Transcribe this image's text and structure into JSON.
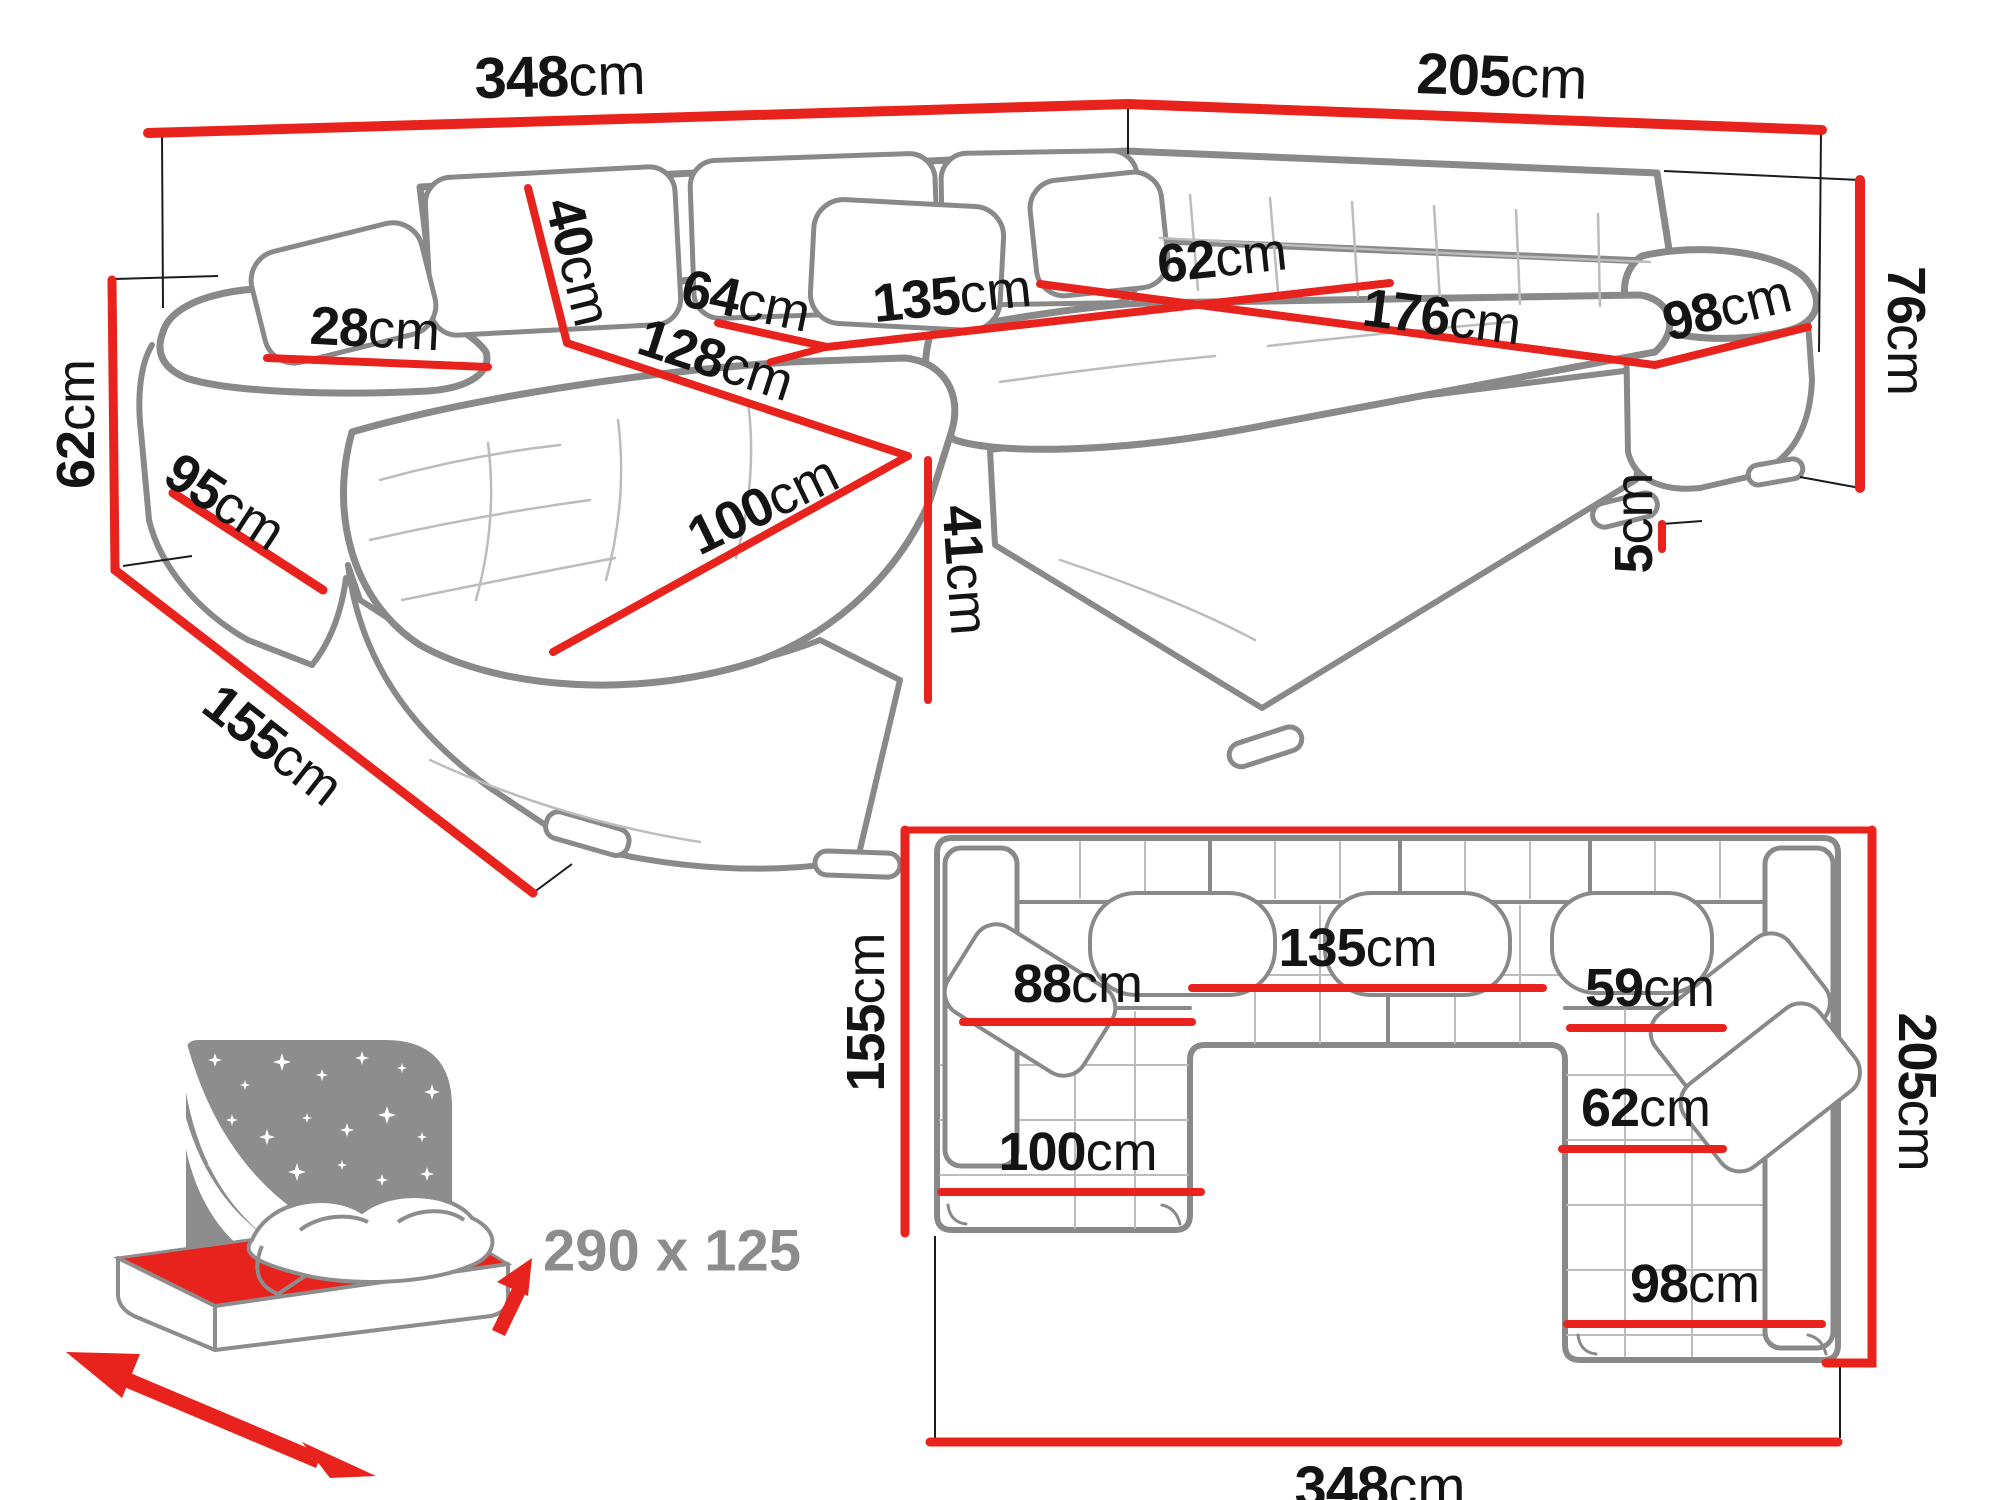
{
  "perspective": {
    "back_width": {
      "num": "348",
      "unit": "cm"
    },
    "right_back_width": {
      "num": "205",
      "unit": "cm"
    },
    "total_height": {
      "num": "76",
      "unit": "cm"
    },
    "armrest_height": {
      "num": "62",
      "unit": "cm"
    },
    "left_side_depth": {
      "num": "95",
      "unit": "cm"
    },
    "chaise_total_depth": {
      "num": "155",
      "unit": "cm"
    },
    "armrest_width": {
      "num": "28",
      "unit": "cm"
    },
    "back_cushion_height": {
      "num": "40",
      "unit": "cm"
    },
    "left_seat_depth": {
      "num": "64",
      "unit": "cm"
    },
    "middle_seat_width": {
      "num": "135",
      "unit": "cm"
    },
    "right_seat_depth": {
      "num": "62",
      "unit": "cm"
    },
    "right_seat_width": {
      "num": "176",
      "unit": "cm"
    },
    "right_end_width": {
      "num": "98",
      "unit": "cm"
    },
    "chaise_length": {
      "num": "128",
      "unit": "cm"
    },
    "chaise_width": {
      "num": "100",
      "unit": "cm"
    },
    "seat_height": {
      "num": "41",
      "unit": "cm"
    },
    "leg_height": {
      "num": "5",
      "unit": "cm"
    }
  },
  "plan": {
    "chaise_depth": {
      "num": "155",
      "unit": "cm"
    },
    "chaise_seat_width": {
      "num": "88",
      "unit": "cm"
    },
    "middle_seat_width": {
      "num": "135",
      "unit": "cm"
    },
    "right_seat_inner": {
      "num": "59",
      "unit": "cm"
    },
    "right_seat_depth": {
      "num": "62",
      "unit": "cm"
    },
    "chaise_width": {
      "num": "100",
      "unit": "cm"
    },
    "right_end_width": {
      "num": "98",
      "unit": "cm"
    },
    "total_depth": {
      "num": "205",
      "unit": "cm"
    },
    "total_width": {
      "num": "348",
      "unit": "cm"
    }
  },
  "sleeping_function": {
    "size_label": "290 x 125"
  },
  "colors": {
    "dimension_red": "#e8231d",
    "outline_gray": "#898989",
    "light_gray": "#bcbcbc",
    "icon_gray": "#8d8d8d",
    "text_black": "#141414"
  }
}
